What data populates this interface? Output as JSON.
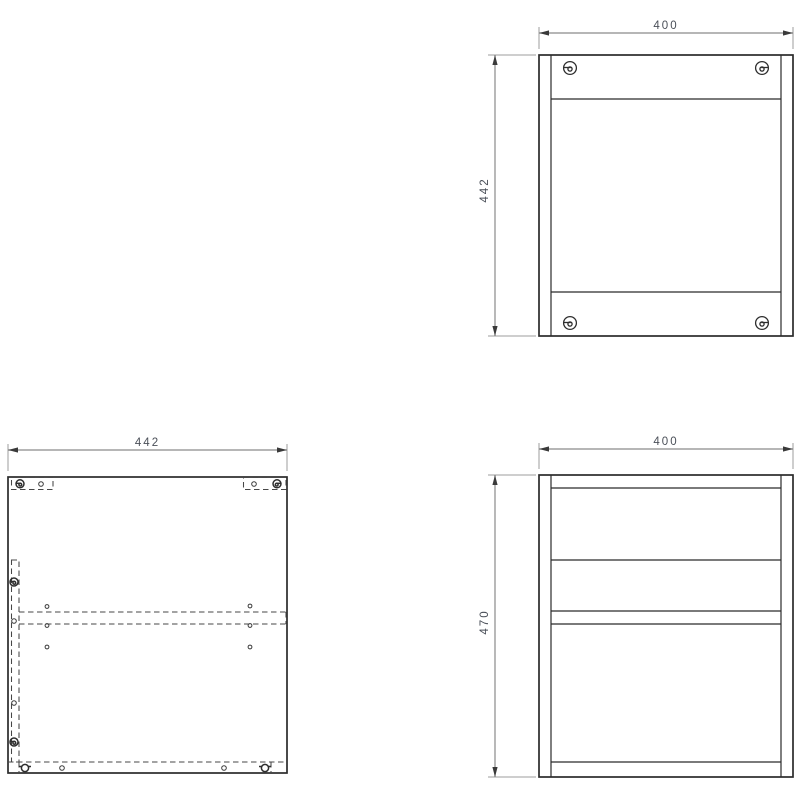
{
  "canvas": {
    "background": "#ffffff",
    "outline_color": "#2b2b2b",
    "hidden_line_color": "#474747",
    "dimension_line_color": "#8a8a8a",
    "dimension_text_color": "#4a4f58"
  },
  "views": {
    "back": {
      "width_label": "400",
      "height_label": "442",
      "width_mm": 400,
      "height_mm": 442,
      "cam_screws": 4
    },
    "side": {
      "width_label": "442",
      "width_mm": 442,
      "cam_fittings": 4,
      "wing_fittings": 2,
      "drill_holes": 12
    },
    "front": {
      "width_label": "400",
      "height_label": "470",
      "width_mm": 400,
      "height_mm": 470,
      "horizontal_shelf_lines": 5
    }
  }
}
